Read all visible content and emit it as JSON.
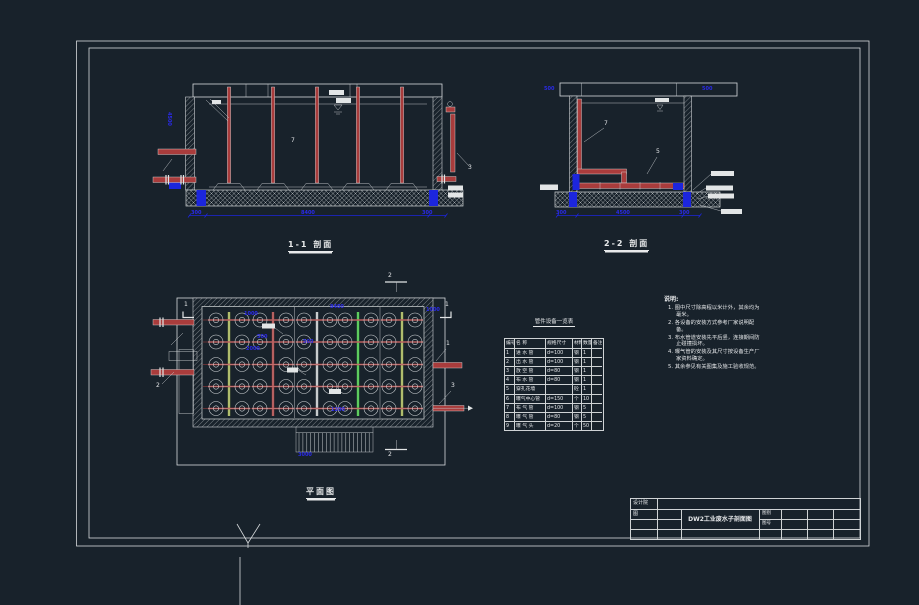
{
  "app": {
    "background_color": "#18222b",
    "line_color": "#d6dadc",
    "pipe_color": "#a93c3c",
    "dim_color": "#2a2ae8",
    "green_pipe_color": "#3ecb3e",
    "olive_pipe_color": "#a8b850"
  },
  "captions": {
    "section1": "1-1 剖面",
    "section2": "2-2 剖面",
    "plan": "平面图"
  },
  "table": {
    "title": "管件设备一览表",
    "headers": [
      "编号",
      "名 称",
      "规格尺寸",
      "材料",
      "数量",
      "备注"
    ],
    "rows": [
      [
        "1",
        "进 水 管",
        "d=100",
        "钢",
        "1",
        ""
      ],
      [
        "2",
        "出 水 管",
        "d=100",
        "钢",
        "1",
        ""
      ],
      [
        "3",
        "放 空 管",
        "d=80",
        "钢",
        "1",
        ""
      ],
      [
        "4",
        "布 水 管",
        "d=80",
        "钢",
        "1",
        ""
      ],
      [
        "5",
        "穿孔花墙",
        "",
        "砼",
        "1",
        ""
      ],
      [
        "6",
        "曝气中心管",
        "d=150",
        "个",
        "10",
        ""
      ],
      [
        "7",
        "布 气 管",
        "d=100",
        "钢",
        "5",
        ""
      ],
      [
        "8",
        "曝 气 管",
        "d=80",
        "钢",
        "5",
        ""
      ],
      [
        "9",
        "曝 气 头",
        "d=20",
        "个",
        "50",
        ""
      ]
    ]
  },
  "notes": {
    "heading": "说明:",
    "items": [
      "图中尺寸除高程以米计外，其余均为毫米。",
      "各设备的安装方式参考厂家说明配备。",
      "布水管道安装先平后竖，连接期间防止碰撞损坏。",
      "曝气管的安装及其尺寸按设备生产厂家资料确定。",
      "其余参见有关图集及施工验收规范。"
    ]
  },
  "title_block": {
    "org": "设计院",
    "col_label": "图",
    "drawing_title": "DW2工业废水子剖面图",
    "sheet_label": "图别",
    "no_label": "图号"
  },
  "dims": {
    "s1_bottom": [
      "300",
      "8400",
      "300"
    ],
    "s1_left": "4500",
    "s2_top": [
      "500",
      "500"
    ],
    "s2_bottom": [
      "300",
      "4500",
      "300"
    ],
    "plan": [
      "1000",
      "8400",
      "2000",
      "500",
      "500",
      "1000",
      "1200",
      "3000"
    ]
  },
  "leaders": {
    "s1": [
      "7",
      "3"
    ],
    "s2": [
      "7",
      "5"
    ],
    "plan": [
      "1",
      "3",
      "2"
    ],
    "cuts": [
      "1",
      "1",
      "2",
      "2"
    ]
  }
}
